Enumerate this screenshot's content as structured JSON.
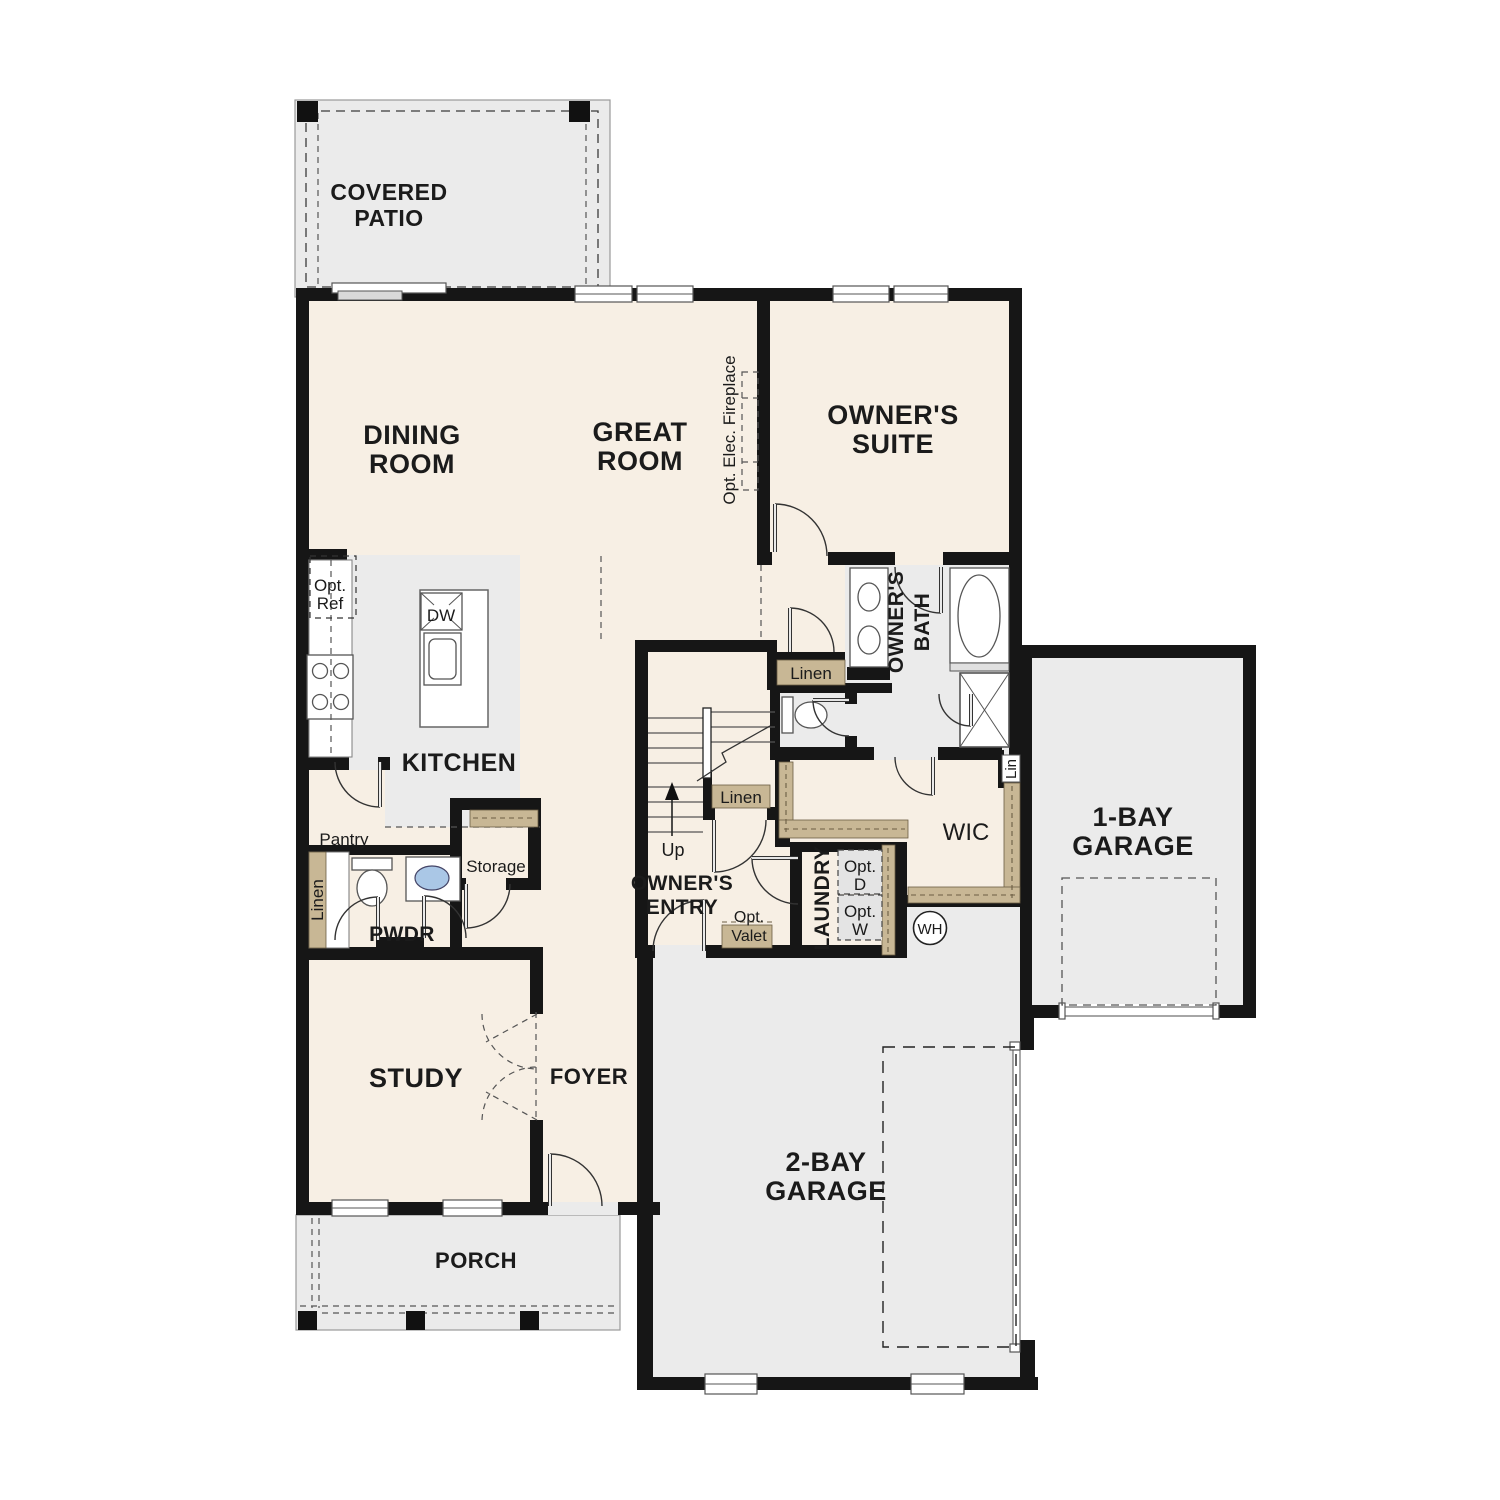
{
  "title": "First Floor Plan",
  "colors": {
    "floor_cream": "#f7efe4",
    "floor_gray": "#ebebeb",
    "cabinet_tan": "#c8b795",
    "wall_black": "#161616",
    "sink_blue": "#aac7e6",
    "appliance_gray": "#e4e4e4"
  },
  "labels": {
    "covered_patio": [
      "COVERED",
      "PATIO"
    ],
    "dining_room": [
      "DINING",
      "ROOM"
    ],
    "great_room": [
      "GREAT",
      "ROOM"
    ],
    "owners_suite": [
      "OWNER'S",
      "SUITE"
    ],
    "opt_elec_fireplace": "Opt. Elec. Fireplace",
    "kitchen": "KITCHEN",
    "opt_ref": [
      "Opt.",
      "Ref"
    ],
    "dw": "DW",
    "pantry": "Pantry",
    "storage": "Storage",
    "linen_left": "Linen",
    "pwdr": "PWDR",
    "owners_bath": [
      "OWNER'S",
      "BATH"
    ],
    "linen_hall": "Linen",
    "linen_stairs": "Linen",
    "lin_wic": "Lin",
    "wic": "WIC",
    "up": "Up",
    "owners_entry": [
      "OWNER'S",
      "ENTRY"
    ],
    "opt_valet": [
      "Opt.",
      "Valet"
    ],
    "laundry": "LAUNDRY",
    "opt_d": [
      "Opt.",
      "D"
    ],
    "opt_w": [
      "Opt.",
      "W"
    ],
    "wh": "WH",
    "one_bay_garage": [
      "1-BAY",
      "GARAGE"
    ],
    "two_bay_garage": [
      "2-BAY",
      "GARAGE"
    ],
    "study": "STUDY",
    "foyer": "FOYER",
    "porch": "PORCH"
  }
}
